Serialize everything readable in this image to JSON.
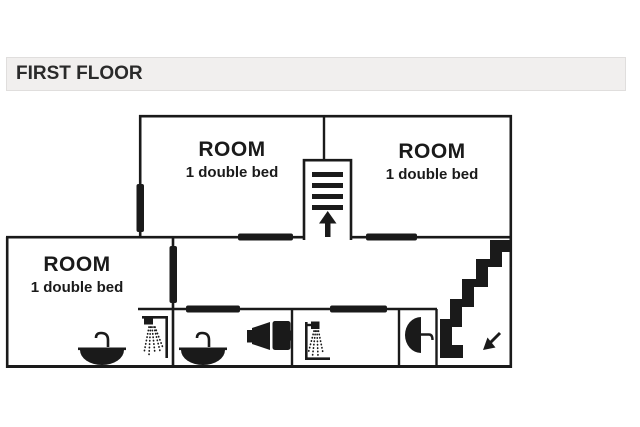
{
  "header": {
    "title": "FIRST FLOOR"
  },
  "floorplan": {
    "rooms": [
      {
        "name": "ROOM",
        "beds": "1 double bed",
        "location": "top-left"
      },
      {
        "name": "ROOM",
        "beds": "1 double bed",
        "location": "top-right"
      },
      {
        "name": "ROOM",
        "beds": "1 double bed",
        "location": "lower-left"
      }
    ],
    "fixtures": [
      {
        "type": "sink",
        "location": "lower-left-room-ensuite"
      },
      {
        "type": "shower",
        "location": "lower-left-room-ensuite"
      },
      {
        "type": "sink",
        "location": "middle-bathroom"
      },
      {
        "type": "toilet-side-view",
        "location": "middle-bathroom"
      },
      {
        "type": "shower",
        "location": "right-bathroom"
      },
      {
        "type": "toilet-top-view",
        "location": "wc-room"
      }
    ],
    "stairs": [
      {
        "type": "stairs-up",
        "arrow": "up",
        "location": "center"
      },
      {
        "type": "stairs-down",
        "arrow": "down-left",
        "location": "bottom-right"
      }
    ]
  },
  "colors": {
    "wall": "#1a1a1a",
    "background": "#ffffff",
    "header_bg": "#f1efee",
    "header_border": "#e0dedd",
    "header_text": "#2a2a2a"
  }
}
